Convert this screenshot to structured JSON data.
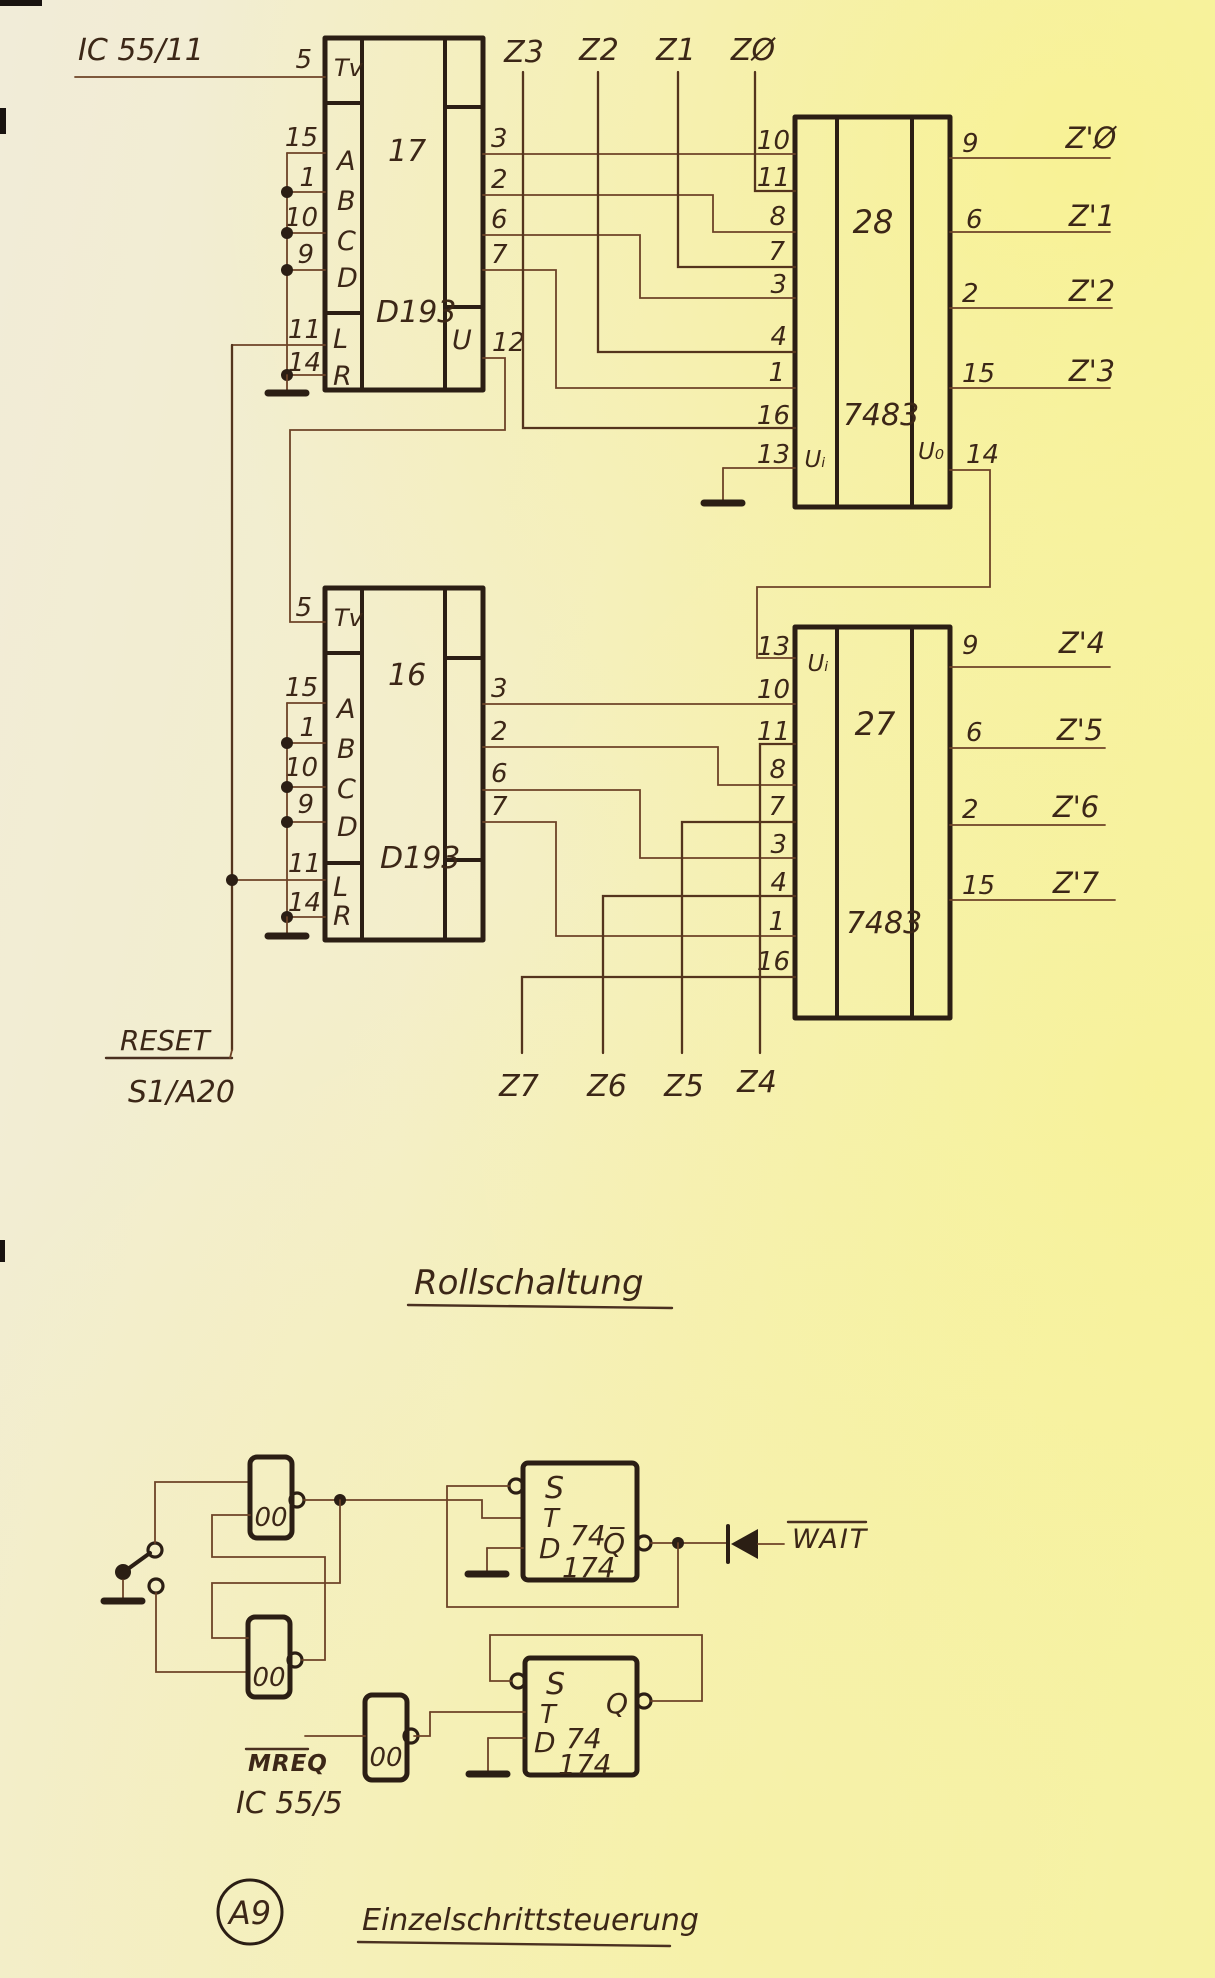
{
  "titles": {
    "ic_ref": "IC 55/11",
    "roll": "Rollschaltung",
    "einzel": "Einzelschrittsteuerung",
    "badge": "A9"
  },
  "signals": {
    "reset": "RESET",
    "reset_src": "S1/A20",
    "mreq": "MREQ",
    "mreq_src": "IC 55/5",
    "wait": "WAIT"
  },
  "counters": {
    "ic17": {
      "name": "17",
      "part": "D193",
      "u_label": "U",
      "pins_left": [
        "5",
        "15",
        "1",
        "10",
        "9",
        "11",
        "14"
      ],
      "cells": [
        "Tv",
        "A",
        "B",
        "C",
        "D",
        "L",
        "R"
      ],
      "pins_right": [
        "3",
        "2",
        "6",
        "7",
        "12"
      ]
    },
    "ic16": {
      "name": "16",
      "part": "D193",
      "pins_left": [
        "5",
        "15",
        "1",
        "10",
        "9",
        "11",
        "14"
      ],
      "cells": [
        "Tv",
        "A",
        "B",
        "C",
        "D",
        "L",
        "R"
      ],
      "pins_right": [
        "3",
        "2",
        "6",
        "7"
      ]
    }
  },
  "adders": {
    "ic28": {
      "name": "28",
      "part": "7483",
      "u_in": "Uᵢ",
      "u_out": "U₀",
      "pins_left": [
        "10",
        "11",
        "8",
        "7",
        "3",
        "4",
        "1",
        "16",
        "13"
      ],
      "pins_right": [
        "9",
        "6",
        "2",
        "15",
        "14"
      ]
    },
    "ic27": {
      "name": "27",
      "part": "7483",
      "u_in": "Uᵢ",
      "pins_left": [
        "13",
        "10",
        "11",
        "8",
        "7",
        "3",
        "4",
        "1",
        "16"
      ],
      "pins_right": [
        "9",
        "6",
        "2",
        "15"
      ]
    }
  },
  "bus": {
    "top": [
      "Z3",
      "Z2",
      "Z1",
      "ZØ"
    ],
    "right_top": [
      "Z'Ø",
      "Z'1",
      "Z'2",
      "Z'3"
    ],
    "right_bottom": [
      "Z'4",
      "Z'5",
      "Z'6",
      "Z'7"
    ],
    "bottom": [
      "Z7",
      "Z6",
      "Z5",
      "Z4"
    ]
  },
  "ff1": {
    "s": "S",
    "t": "T",
    "d": "D",
    "chip_top": "74",
    "chip_bot": "174",
    "q": "Q̅"
  },
  "ff2": {
    "s": "S",
    "t": "T",
    "d": "D",
    "chip_top": "74",
    "chip_bot": "174",
    "q": "Q"
  },
  "gates": {
    "nand": "00"
  }
}
